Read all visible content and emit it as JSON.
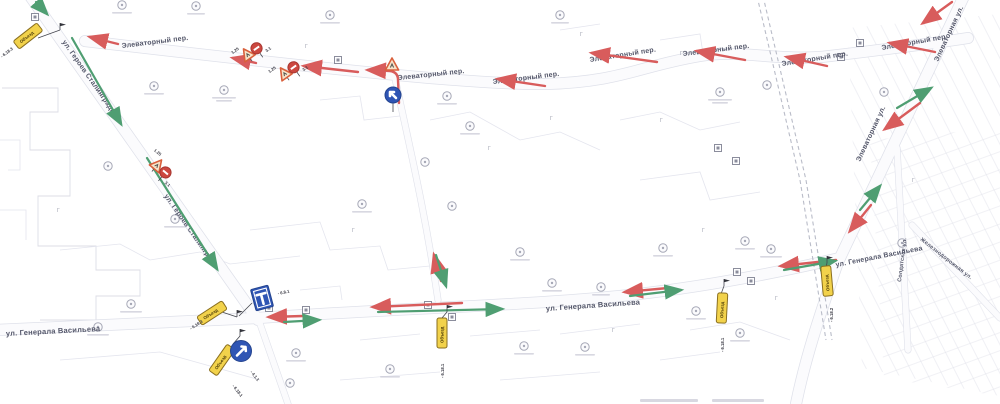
{
  "document": {
    "kind": "scanned traffic detour scheme over city map",
    "background": "#ffffff"
  },
  "colors": {
    "closed_direction_red": "#d85c5c",
    "open_direction_green": "#4f9e72",
    "plate_yellow": "#f2d24b",
    "sign_blue": "#2f55b4",
    "no_entry_red": "#cc4840",
    "map_linework": "#dcdde6",
    "railway": "#b9bcc8"
  },
  "streets": {
    "elevatorny_lane": "Элеваторный пер.",
    "geroev_stalingrada": "ул. Героев Сталинграда",
    "generala_vasilyeva": "ул. Генерала Васильева",
    "elevatornaya_street": "Элеваторная ул.",
    "soldatskaya_street": "Солдатская ул.",
    "zheleznodorozhnaya_street": "Железнодорожная ул."
  },
  "signs": {
    "detour_plate_text": "Объезд",
    "label_dead_end": "- 6.8.1",
    "label_detour_1": "- 6.18.1",
    "label_detour_2": "- 6.18.2",
    "label_detour_3": "- 6.18.3",
    "label_direction": "- 4.1.1",
    "label_roadworks": "1.25",
    "label_no_entry": "3.1"
  },
  "map": {
    "corner_glyph": "Г"
  }
}
